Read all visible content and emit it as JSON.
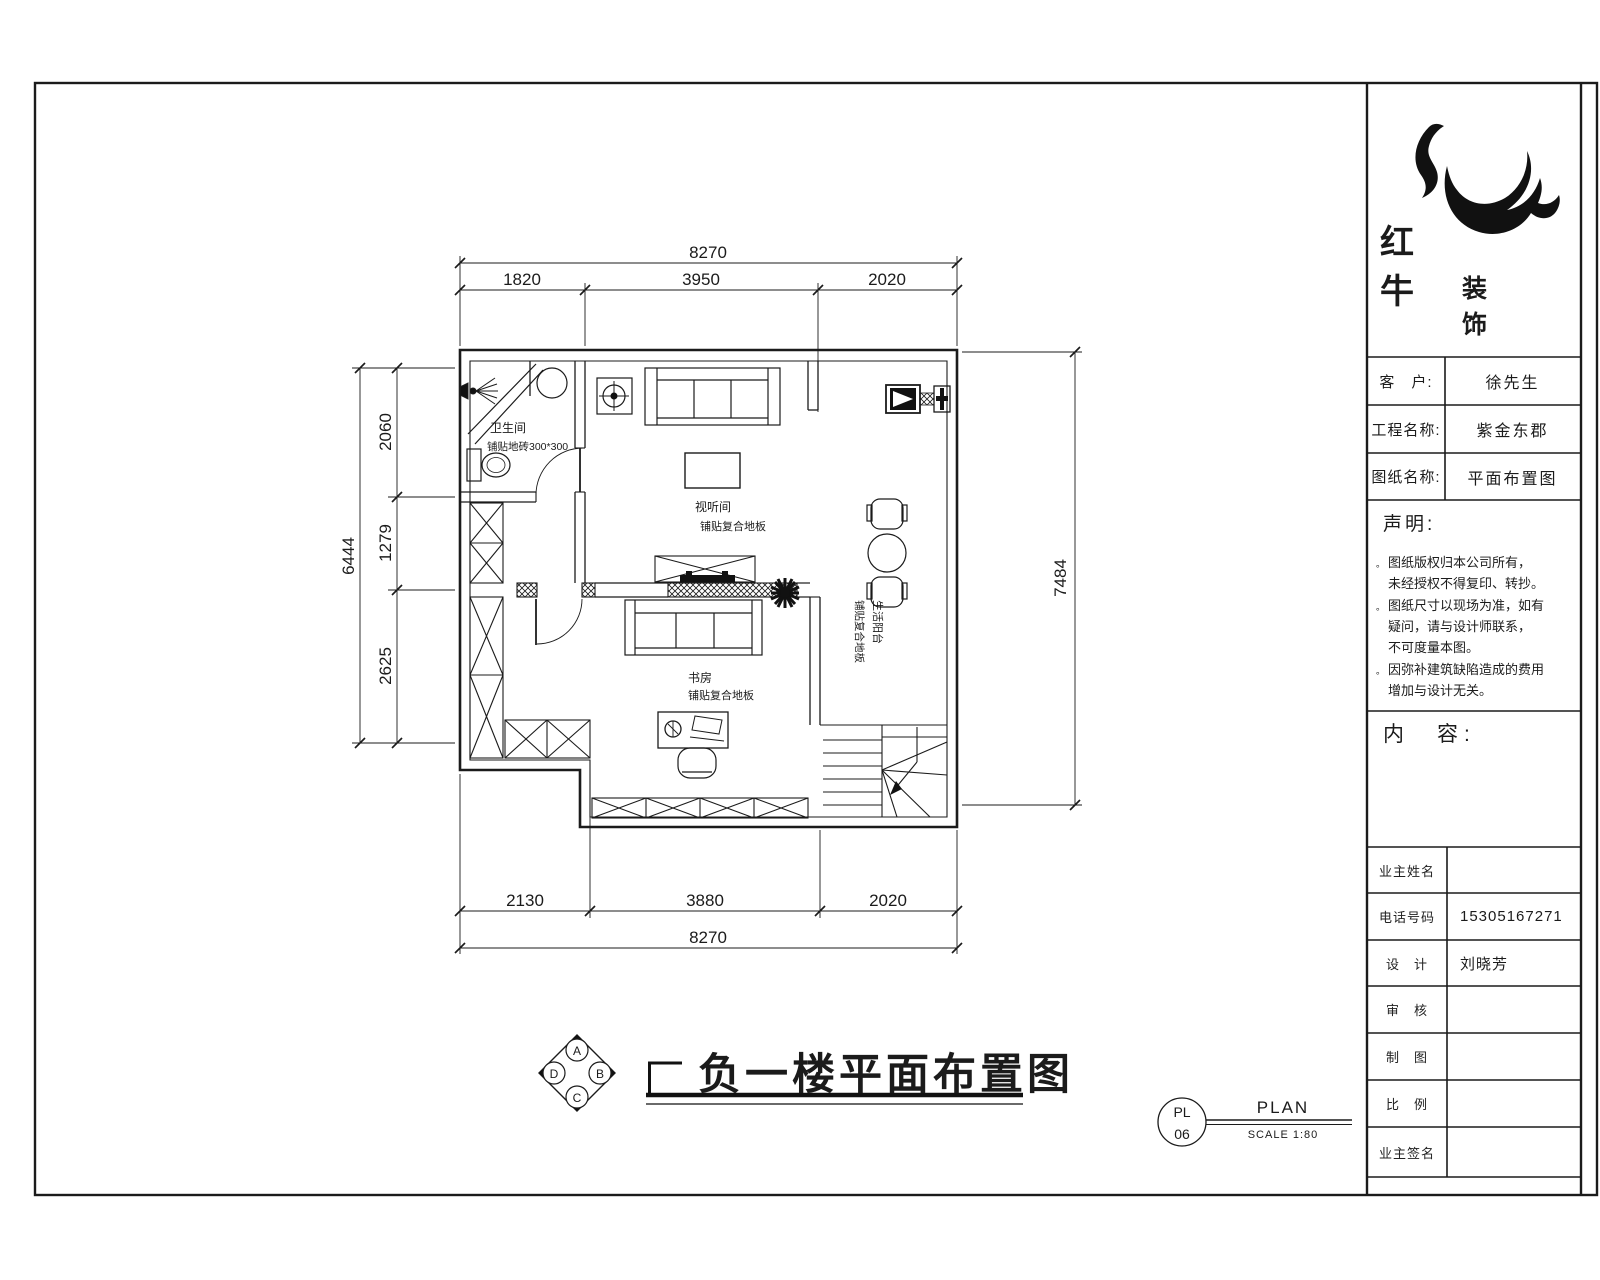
{
  "title_block": {
    "logo": {
      "name_line1": "红　牛",
      "name_line2": "装　饰"
    },
    "info_rows": [
      {
        "label": "客　户:",
        "value": "徐先生"
      },
      {
        "label": "工程名称:",
        "value": "紫金东郡"
      },
      {
        "label": "图纸名称:",
        "value": "平面布置图"
      }
    ],
    "statement": {
      "heading": "声明:",
      "bullet": "。",
      "items": [
        {
          "line1": "图纸版权归本公司所有，",
          "line2": "未经授权不得复印、转抄。"
        },
        {
          "line1": "图纸尺寸以现场为准，如有",
          "line2": "疑问，请与设计师联系，",
          "line3": "不可度量本图。"
        },
        {
          "line1": "因弥补建筑缺陷造成的费用",
          "line2": "增加与设计无关。"
        }
      ]
    },
    "content_heading": "内　容:",
    "sign_rows": [
      {
        "label": "业主姓名",
        "value": ""
      },
      {
        "label": "电话号码",
        "value": "15305167271"
      },
      {
        "label": "设　计",
        "value": "刘晓芳"
      },
      {
        "label": "审　核",
        "value": ""
      },
      {
        "label": "制　图",
        "value": ""
      },
      {
        "label": "比　例",
        "value": ""
      },
      {
        "label": "业主签名",
        "value": ""
      }
    ]
  },
  "drawing": {
    "title": "负一楼平面布置图",
    "compass": {
      "top": "A",
      "right": "B",
      "bottom": "C",
      "left": "D"
    },
    "sheet_ref": {
      "code_top": "PL",
      "code_bottom": "06",
      "label": "PLAN",
      "scale": "SCALE 1:80"
    }
  },
  "plan": {
    "rooms": [
      {
        "name": "卫生间",
        "note": "铺贴地砖300*300"
      },
      {
        "name": "视听间",
        "note": "铺贴复合地板"
      },
      {
        "name": "书房",
        "note": "铺贴复合地板"
      },
      {
        "name": "生活阳台",
        "note": "铺贴复合地板"
      }
    ],
    "dims": {
      "top": {
        "total": "8270",
        "segments": [
          "1820",
          "3950",
          "2020"
        ]
      },
      "bottom": {
        "total": "8270",
        "segments": [
          "2130",
          "3880",
          "2020"
        ]
      },
      "left": {
        "total": "6444",
        "segments": [
          "2060",
          "1279",
          "2625"
        ]
      },
      "right": {
        "total": "7484"
      }
    }
  }
}
